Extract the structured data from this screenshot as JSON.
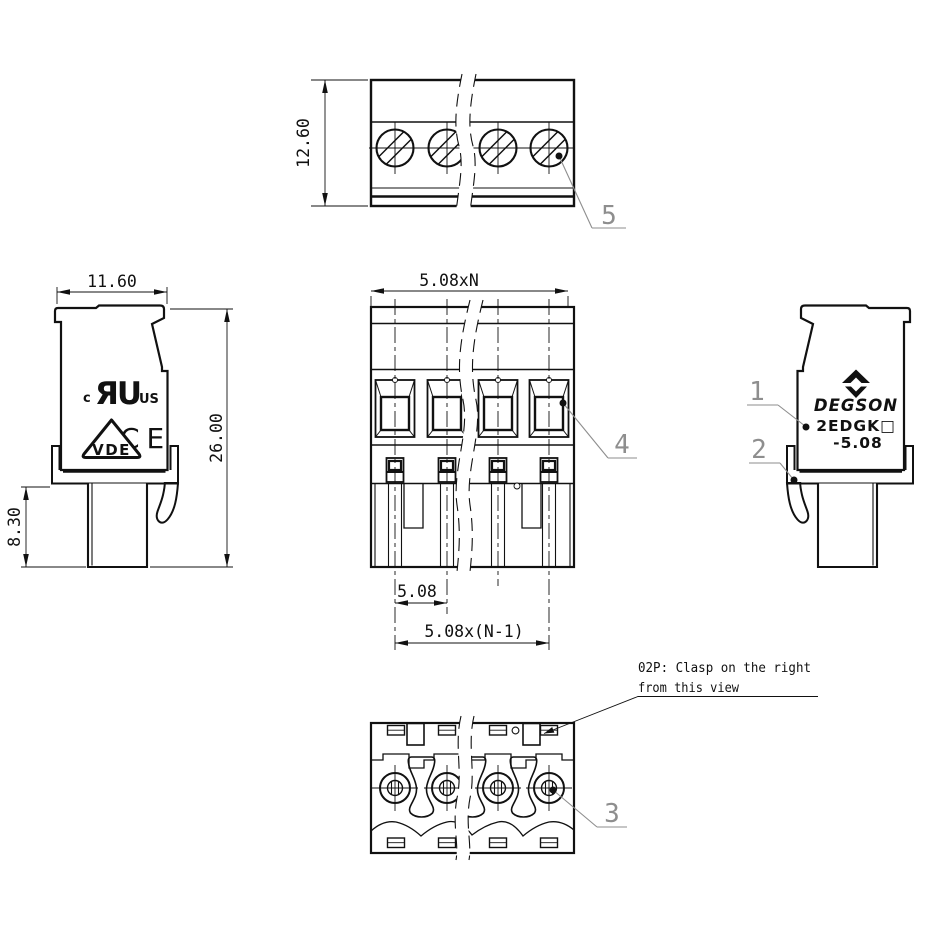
{
  "colors": {
    "line": "#111111",
    "callout": "#8e8e8e",
    "background": "#ffffff"
  },
  "top_view": {
    "height_dim": "12.60",
    "callout_screw": "5"
  },
  "left_view": {
    "width_dim": "11.60",
    "total_height_dim": "26.00",
    "tail_height_dim": "8.30",
    "marks": {
      "ul_prefix": "c",
      "ul_mark": "ЯU",
      "ul_suffix": "US",
      "ce": "CE",
      "vde": "VDE"
    }
  },
  "front_view": {
    "overall_width_dim": "5.08xN",
    "pitch_dim": "5.08",
    "span_dim": "5.08x(N-1)",
    "callout_opening": "4"
  },
  "right_view": {
    "callout_housing": "1",
    "callout_clasp": "2",
    "brand": {
      "name": "DEGSON",
      "model": "2EDGK□",
      "pitch": "-5.08"
    }
  },
  "bottom_view": {
    "callout_hole": "3",
    "note_line1": "02P: Clasp on the right",
    "note_line2": "from this view"
  }
}
